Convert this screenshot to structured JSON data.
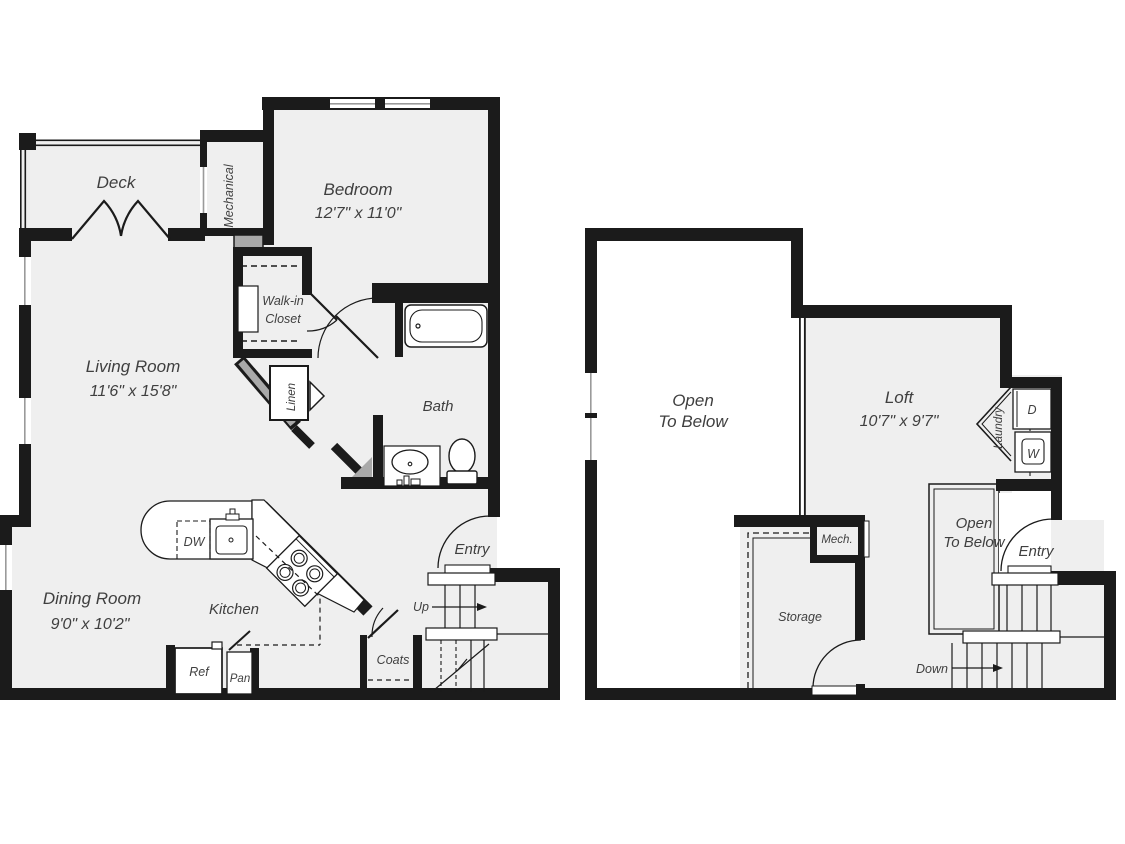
{
  "floorplan": {
    "floor1": {
      "rooms": {
        "deck": {
          "label": "Deck"
        },
        "mechanical": {
          "label": "Mechanical"
        },
        "bedroom": {
          "label": "Bedroom",
          "dims": "12'7\" x 11'0\""
        },
        "walk_in_closet": {
          "line1": "Walk-in",
          "line2": "Closet"
        },
        "linen": {
          "label": "Linen"
        },
        "living_room": {
          "label": "Living Room",
          "dims": "11'6\" x 15'8\""
        },
        "bath": {
          "label": "Bath"
        },
        "dining_room": {
          "label": "Dining Room",
          "dims": "9'0\" x 10'2\""
        },
        "kitchen": {
          "label": "Kitchen"
        },
        "entry": {
          "label": "Entry"
        },
        "coats": {
          "label": "Coats"
        },
        "stairs_up": {
          "label": "Up"
        }
      },
      "fixtures": {
        "dishwasher": "DW",
        "refrigerator": "Ref",
        "pantry": "Pan"
      }
    },
    "floor2": {
      "rooms": {
        "open_to_below_main": {
          "line1": "Open",
          "line2": "To Below"
        },
        "loft": {
          "label": "Loft",
          "dims": "10'7\" x 9'7\""
        },
        "laundry": {
          "label": "Laundry"
        },
        "open_to_below_entry": {
          "line1": "Open",
          "line2": "To Below"
        },
        "entry": {
          "label": "Entry"
        },
        "storage": {
          "label": "Storage"
        },
        "mech": {
          "label": "Mech."
        },
        "stairs_down": {
          "label": "Down"
        }
      },
      "fixtures": {
        "dryer": "D",
        "washer": "W"
      }
    },
    "colors": {
      "wall": "#1b1b1b",
      "floor": "#efefef",
      "accent_gray": "#a9a9a9",
      "background": "#ffffff",
      "text": "#3f3f3f"
    }
  }
}
